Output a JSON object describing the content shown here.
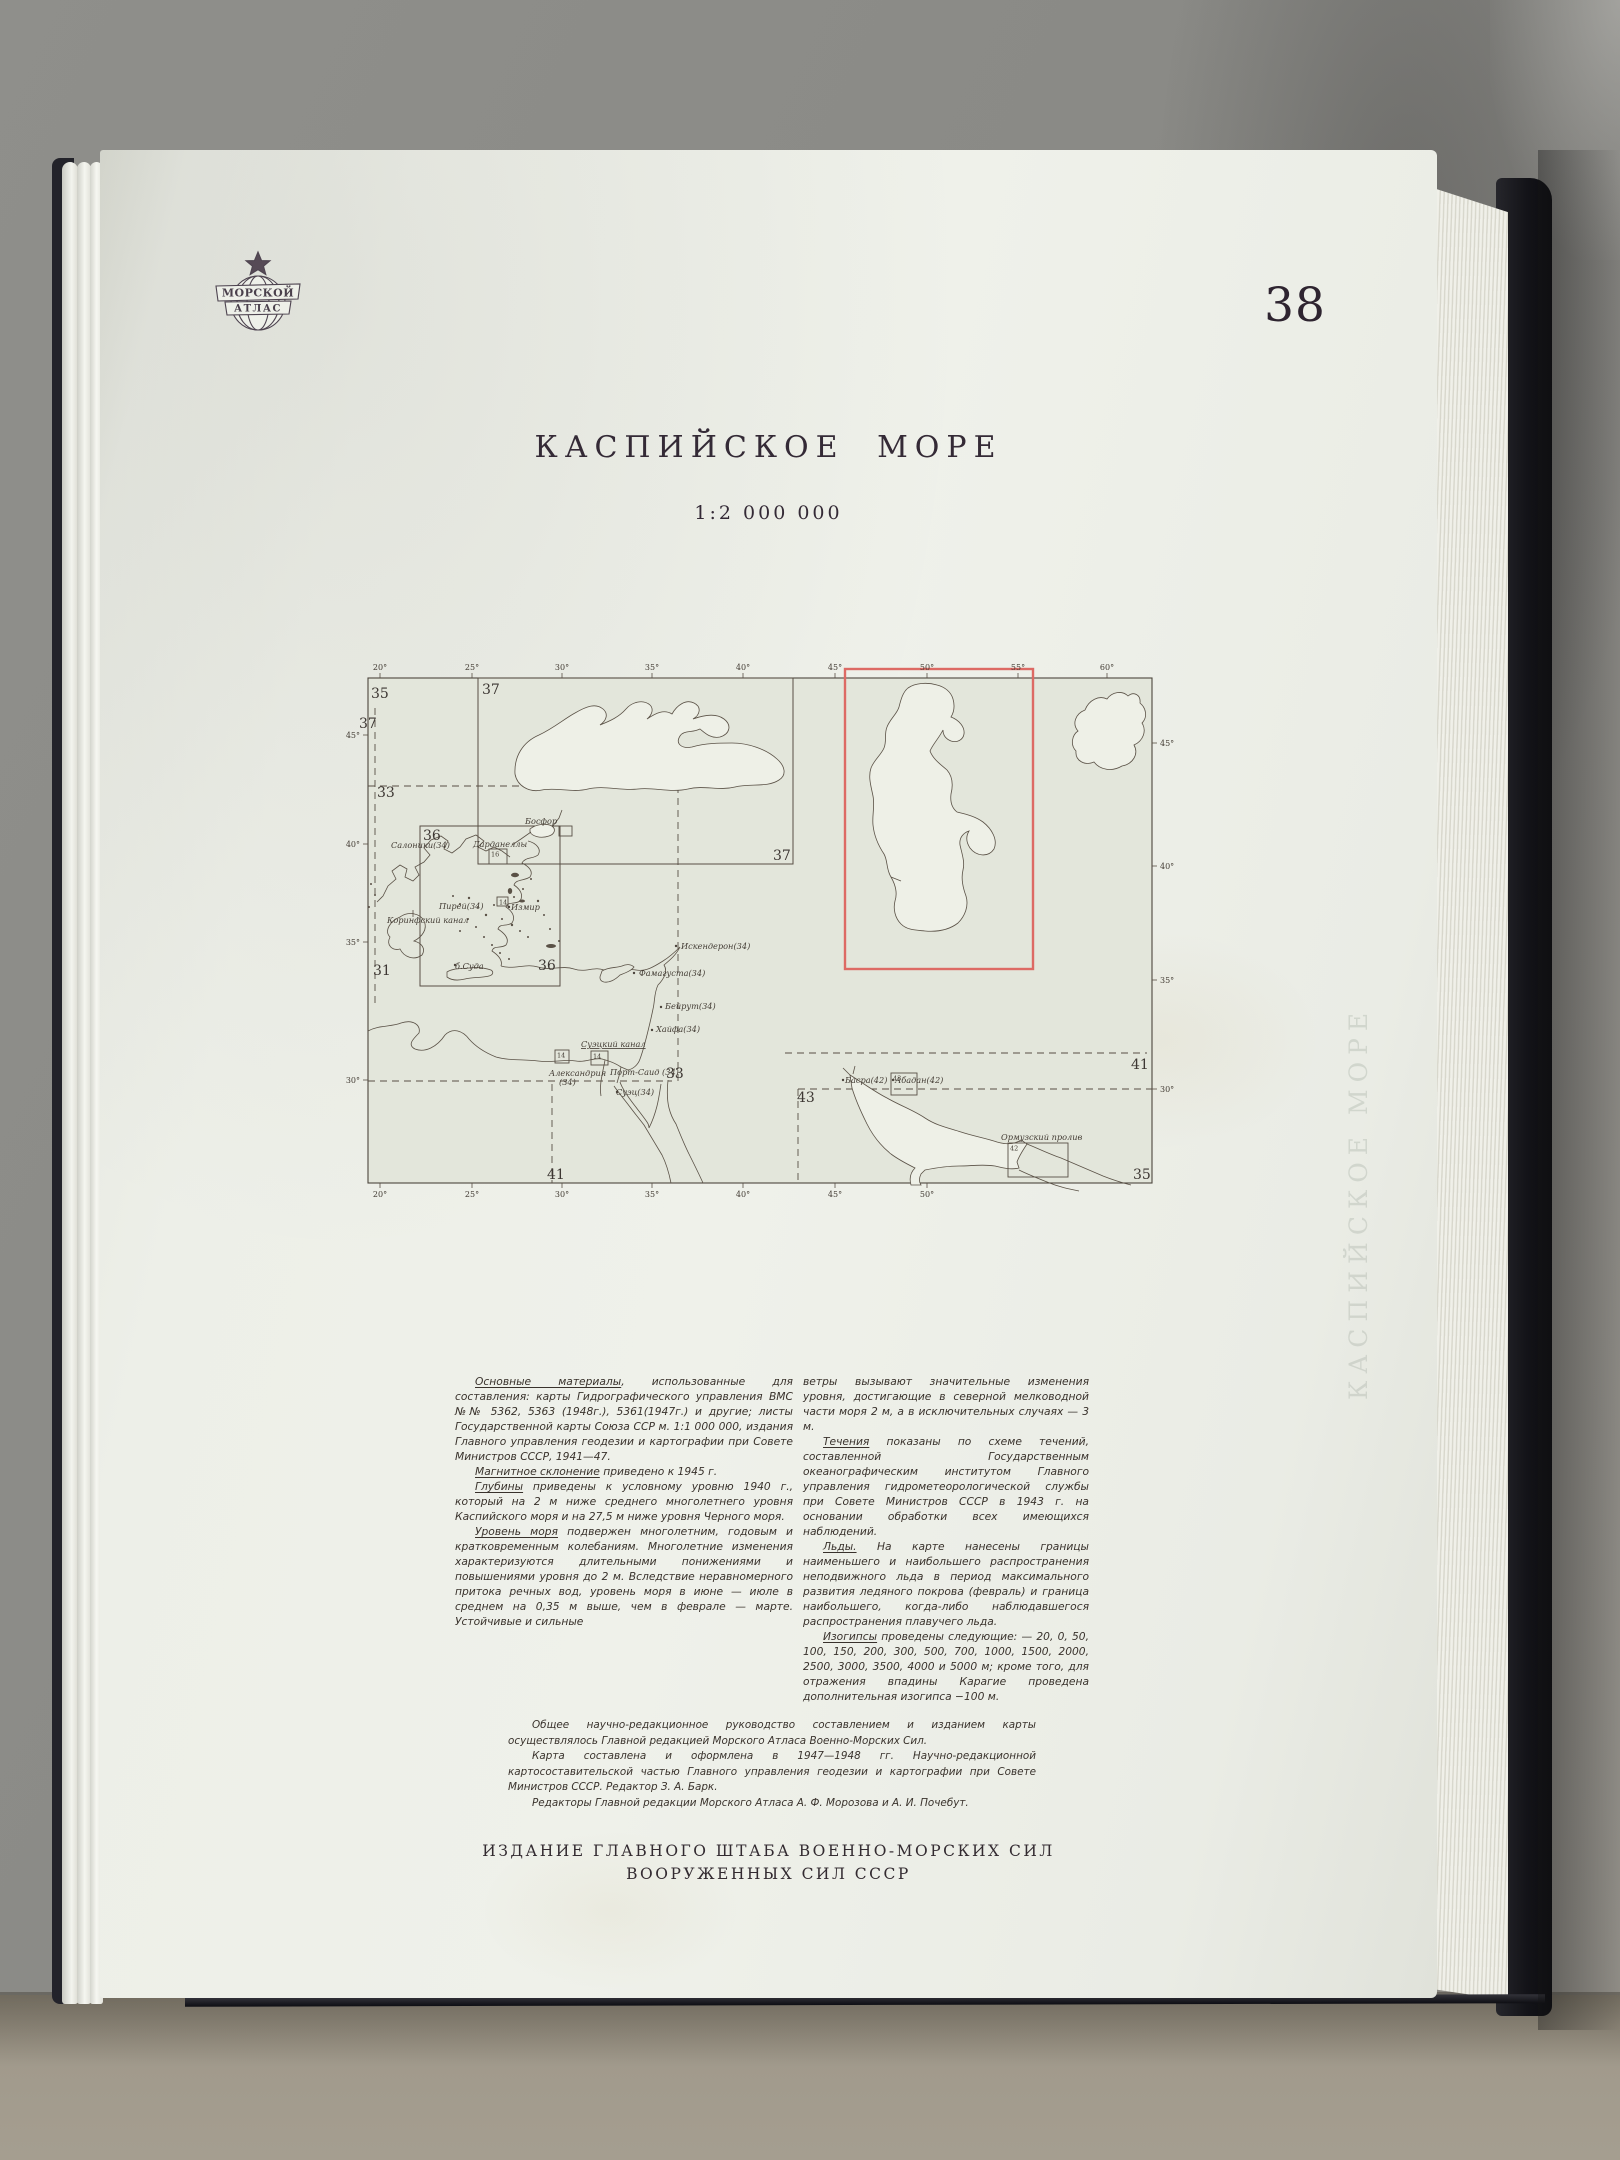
{
  "page_number": "38",
  "logo": {
    "line1": "МОРСКОЙ",
    "line2": "АТЛАС"
  },
  "title": "КАСПИЙСКОЕ МОРЕ",
  "scale": "1:2 000 000",
  "ghost_text": "КАСПИЙСКОЕ МОРЕ",
  "imprint": [
    "ИЗДАНИЕ ГЛАВНОГО ШТАБА ВОЕННО-МОРСКИХ СИЛ",
    "ВООРУЖЕННЫХ СИЛ СССР"
  ],
  "map": {
    "highlight_color": "#dd6a64",
    "line_color": "#584f45",
    "label_color": "#433c34",
    "ticks": {
      "top": [
        [
          "20°",
          17
        ],
        [
          "25°",
          109
        ],
        [
          "30°",
          199
        ],
        [
          "35°",
          289
        ],
        [
          "40°",
          380
        ],
        [
          "45°",
          472
        ],
        [
          "50°",
          564
        ],
        [
          "55°",
          655
        ],
        [
          "60°",
          744
        ]
      ],
      "bottom": [
        [
          "20°",
          17
        ],
        [
          "25°",
          109
        ],
        [
          "30°",
          199
        ],
        [
          "35°",
          289
        ],
        [
          "40°",
          380
        ],
        [
          "45°",
          472
        ],
        [
          "50°",
          564
        ]
      ],
      "left": [
        [
          "45°",
          57
        ],
        [
          "40°",
          166
        ],
        [
          "35°",
          264
        ],
        [
          "30°",
          402
        ]
      ],
      "right": [
        [
          "45°",
          65
        ],
        [
          "40°",
          188
        ],
        [
          "35°",
          302
        ],
        [
          "30°",
          411
        ]
      ]
    },
    "sheet_labels": [
      {
        "t": "35",
        "x": 8,
        "y": 20
      },
      {
        "t": "37",
        "x": -4,
        "y": 50
      },
      {
        "t": "33",
        "x": 14,
        "y": 119
      },
      {
        "t": "31",
        "x": 10,
        "y": 297
      },
      {
        "t": "37",
        "x": 119,
        "y": 16
      },
      {
        "t": "37",
        "x": 410,
        "y": 182
      },
      {
        "t": "36",
        "x": 60,
        "y": 162
      },
      {
        "t": "36",
        "x": 175,
        "y": 292
      },
      {
        "t": "33",
        "x": 303,
        "y": 400
      },
      {
        "t": "41",
        "x": 184,
        "y": 501
      },
      {
        "t": "41",
        "x": 768,
        "y": 391
      },
      {
        "t": "43",
        "x": 434,
        "y": 424
      },
      {
        "t": "35",
        "x": 770,
        "y": 501
      }
    ],
    "place_labels": [
      {
        "t": "Салоники(34)",
        "x": 28,
        "y": 170
      },
      {
        "t": "Босфор",
        "x": 162,
        "y": 146
      },
      {
        "t": "Дарданеллы",
        "x": 110,
        "y": 169
      },
      {
        "t": "Измир",
        "x": 148,
        "y": 232
      },
      {
        "t": "Пирей(34)",
        "x": 76,
        "y": 231
      },
      {
        "t": "Коринфский канал",
        "x": 24,
        "y": 245
      },
      {
        "t": "б.Суда",
        "x": 92,
        "y": 291
      },
      {
        "t": "Искендерон(34)",
        "x": 318,
        "y": 271
      },
      {
        "t": "Фамагуста(34)",
        "x": 276,
        "y": 298
      },
      {
        "t": "Бейрут(34)",
        "x": 302,
        "y": 331
      },
      {
        "t": "Хайфа(34)",
        "x": 293,
        "y": 354
      },
      {
        "t": "Суэцкий канал",
        "x": 218,
        "y": 369,
        "u": true
      },
      {
        "t": "Александрия",
        "x": 186,
        "y": 398
      },
      {
        "t": "(34)",
        "x": 196,
        "y": 407
      },
      {
        "t": "Порт-Саид (34)",
        "x": 247,
        "y": 397
      },
      {
        "t": "Суэц(34)",
        "x": 253,
        "y": 417
      },
      {
        "t": "Басра(42)",
        "x": 482,
        "y": 405
      },
      {
        "t": "Абадан(42)",
        "x": 532,
        "y": 405
      },
      {
        "t": "Ормузский пролив",
        "x": 638,
        "y": 462
      }
    ],
    "city_dots": [
      [
        146,
        229
      ],
      [
        313,
        268
      ],
      [
        271,
        295
      ],
      [
        298,
        329
      ],
      [
        289,
        352
      ],
      [
        92,
        287
      ],
      [
        480,
        402
      ],
      [
        530,
        402
      ],
      [
        254,
        414
      ]
    ],
    "inset_boxes": [
      {
        "x": 196,
        "y": 148,
        "w": 13,
        "h": 10,
        "label": ""
      },
      {
        "x": 126,
        "y": 171,
        "w": 18,
        "h": 15,
        "label": "16"
      },
      {
        "x": 134,
        "y": 219,
        "w": 11,
        "h": 9,
        "label": "14"
      },
      {
        "x": 192,
        "y": 372,
        "w": 14,
        "h": 13,
        "label": "14"
      },
      {
        "x": 228,
        "y": 373,
        "w": 17,
        "h": 14,
        "label": "14"
      },
      {
        "x": 528,
        "y": 395,
        "w": 26,
        "h": 22,
        "label": "43"
      },
      {
        "x": 645,
        "y": 465,
        "w": 60,
        "h": 34,
        "label": "42"
      }
    ],
    "dashes": [
      [
        5,
        108,
        315,
        108
      ],
      [
        315,
        108,
        315,
        403
      ],
      [
        5,
        403,
        309,
        403
      ],
      [
        189,
        406,
        189,
        505
      ],
      [
        422,
        375,
        784,
        375
      ],
      [
        435,
        411,
        789,
        411
      ],
      [
        435,
        411,
        435,
        505
      ],
      [
        12,
        30,
        12,
        330
      ]
    ],
    "sheet_boxes": [
      {
        "x": 115,
        "y": 0,
        "w": 315,
        "h": 186
      },
      {
        "x": 57,
        "y": 148,
        "w": 140,
        "h": 160
      }
    ],
    "highlight_box": {
      "x": 482,
      "y": -9,
      "w": 188,
      "h": 300
    }
  },
  "notes_left": [
    {
      "lead": "Основные материалы",
      "text": ", использованные для составления: карты Гидрографического управления ВМС №№ 5362, 5363 (1948г.), 5361(1947г.) и другие; листы Государственной карты Союза ССР м. 1:1 000 000, издания Главного управления геодезии и картографии при Совете Министров СССР, 1941—47."
    },
    {
      "lead": "Магнитное склонение",
      "text": " приведено к 1945 г."
    },
    {
      "lead": "Глубины",
      "text": " приведены к условному уровню 1940 г., который на 2 м ниже среднего многолетнего уровня Каспийского моря и на 27,5 м ниже уровня Черного моря."
    },
    {
      "lead": "Уровень моря",
      "text": " подвержен многолетним, годовым и кратковременным колебаниям. Многолетние изменения характеризуются длительными понижениями и повышениями уровня до 2 м. Вследствие неравномерного притока речных вод, уровень моря в июне — июле в среднем на 0,35 м выше, чем в феврале — марте. Устойчивые и сильные"
    }
  ],
  "notes_right": [
    {
      "lead": "",
      "noindent": true,
      "text": "ветры вызывают значительные изменения уровня, достигающие в северной мелководной части моря 2 м, а в исключительных случаях — 3 м."
    },
    {
      "lead": "Течения",
      "text": " показаны по схеме течений, составленной Государственным океанографическим институтом Главного управления гидрометеорологической службы при Совете Министров СССР в 1943 г. на основании обработки всех имеющихся наблюдений."
    },
    {
      "lead": "Льды.",
      "text": " На карте нанесены границы наименьшего и наибольшего распространения неподвижного льда в период максимального развития ледяного покрова (февраль) и граница наибольшего, когда-либо наблюдавшегося распространения плавучего льда."
    },
    {
      "lead": "Изогипсы",
      "text": " проведены следующие: — 20, 0, 50, 100, 150, 200, 300, 500, 700, 1000, 1500, 2000, 2500, 3000, 3500, 4000 и 5000 м; кроме того, для отражения впадины Карагие проведена дополнительная изогипса −100 м."
    }
  ],
  "editorial": [
    "Общее научно-редакционное руководство составлением и изданием карты осуществлялось Главной редакцией Морского Атласа Военно-Морских Сил.",
    "Карта составлена и оформлена в 1947—1948 гг. Научно-редакционной картосоставительской частью Главного управления геодезии и картографии при Совете Министров СССР.  Редактор З. А. Барк.",
    "Редакторы Главной редакции Морского Атласа А. Ф. Морозова и А. И. Почебут."
  ]
}
